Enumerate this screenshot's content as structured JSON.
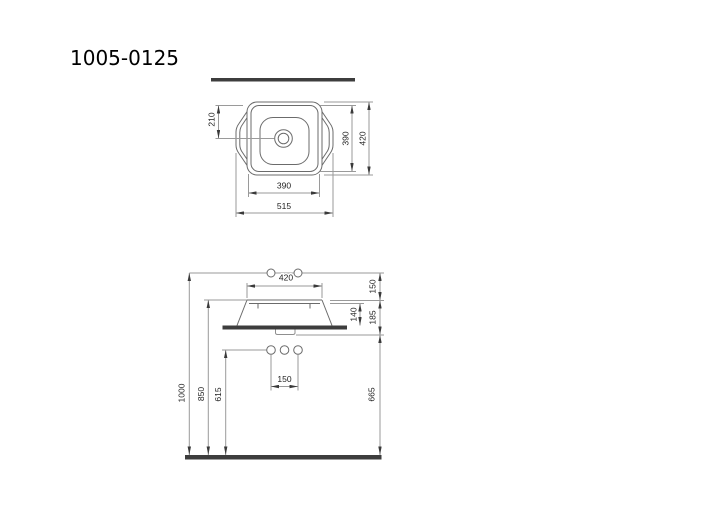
{
  "title": "1005-0125",
  "colors": {
    "background": "#ffffff",
    "object_line": "#6b6b6b",
    "dimension_line": "#9a9a9a",
    "thick_bar": "#3d3d3d",
    "text": "#222222"
  },
  "top_view": {
    "dim_drain_offset": "210",
    "dim_inner_height": "390",
    "dim_outer_height": "420",
    "dim_inner_width": "390",
    "dim_outer_width": "515"
  },
  "side_view": {
    "dim_rim_width": "420",
    "dim_faucet_above_rim": "150",
    "dim_basin_height": "140",
    "dim_rim_to_underside": "185",
    "dim_hole_spacing": "150",
    "dim_holes_height": "615",
    "dim_rim_height": "850",
    "dim_faucet_line_height": "1000",
    "dim_underside_height": "665"
  }
}
